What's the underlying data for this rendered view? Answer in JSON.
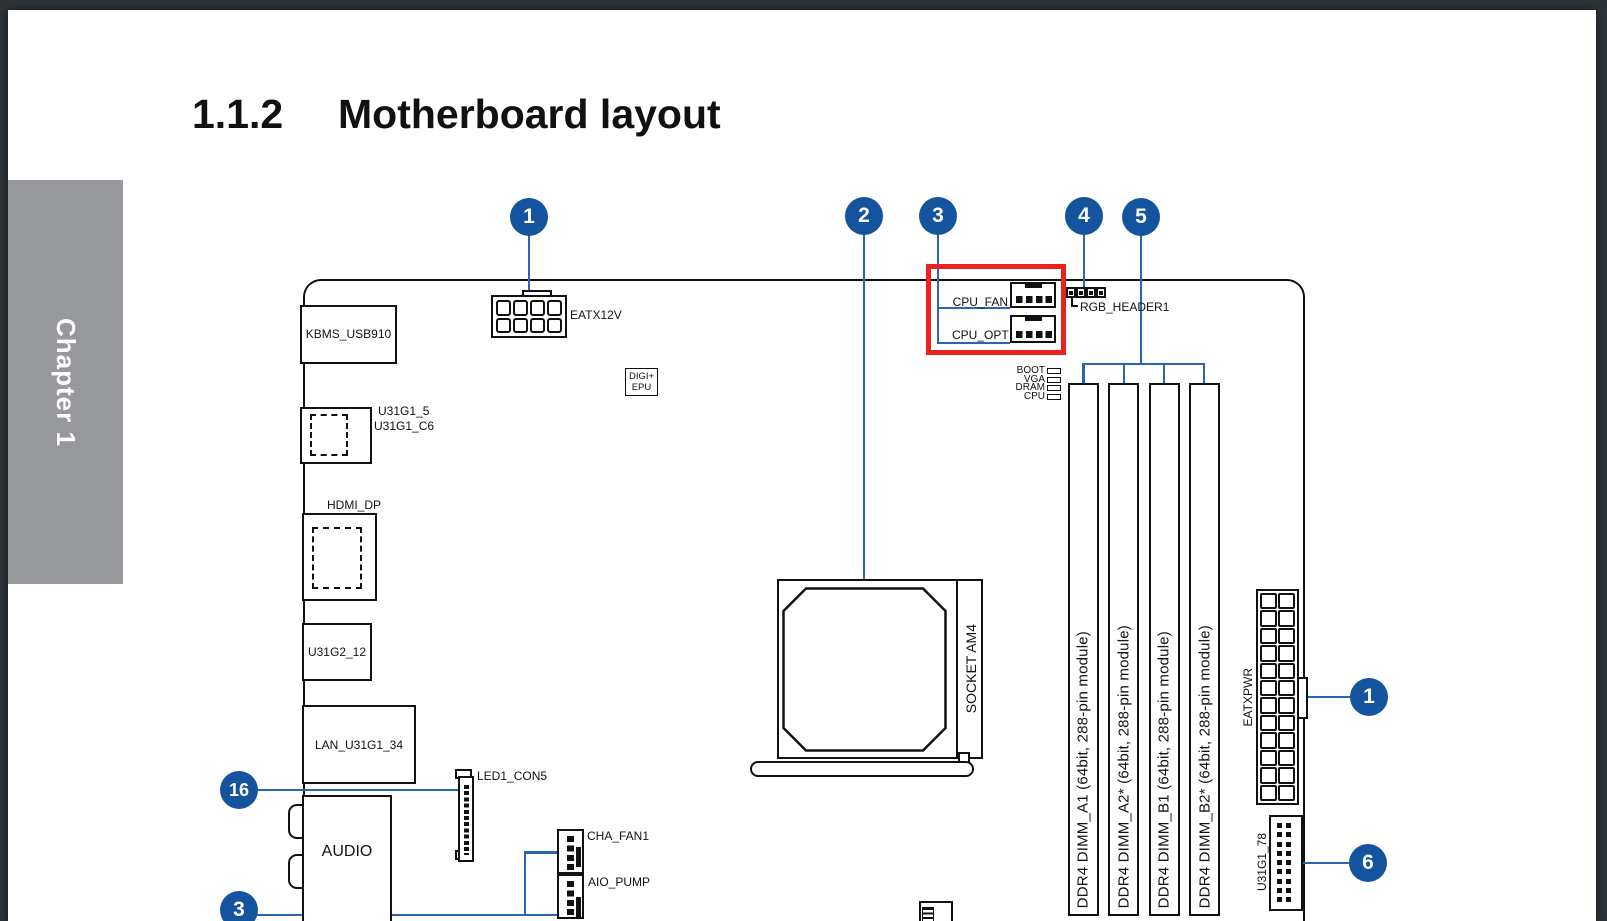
{
  "page": {
    "chapter_tab": "Chapter 1",
    "section_number": "1.1.2",
    "section_title": "Motherboard layout"
  },
  "callouts": {
    "eatx12v": "1",
    "socket": "2",
    "fan_top": "3",
    "rgb": "4",
    "dimm": "5",
    "led_strip": "16",
    "fan_bottom": "3",
    "atx_power": "1",
    "usb_front": "6"
  },
  "connectors": {
    "eatx12v": "EATX12V",
    "kbms": "KBMS_USB910",
    "u31g1_5": "U31G1_5",
    "u31g1_c6": "U31G1_C6",
    "digi_line1": "DIGI+",
    "digi_line2": "EPU",
    "hdmi": "HDMI_DP",
    "u31g2_12": "U31G2_12",
    "lan": "LAN_U31G1_34",
    "audio": "AUDIO",
    "led1_con5": "LED1_CON5",
    "cha_fan1": "CHA_FAN1",
    "aio_pump": "AIO_PUMP",
    "cpu_fan": "CPU_FAN",
    "cpu_opt": "CPU_OPT",
    "rgb_header": "RGB_HEADER1",
    "socket": "SOCKET AM4",
    "eatxpwr": "EATXPWR",
    "u31g1_78": "U31G1_78"
  },
  "leds": {
    "boot": "BOOT",
    "vga": "VGA",
    "dram": "DRAM",
    "cpu": "CPU"
  },
  "dimm_slots": [
    "DDR4 DIMM_A1 (64bit, 288-pin module)",
    "DDR4 DIMM_A2* (64bit, 288-pin module)",
    "DDR4 DIMM_B1 (64bit, 288-pin module)",
    "DDR4 DIMM_B2* (64bit, 288-pin module)"
  ],
  "colors": {
    "callout_blue": "#14539e",
    "leader_blue": "#2a66b0",
    "highlight_red": "#e8231f",
    "tab_gray": "#97989b",
    "frame_dark": "#2e3338",
    "line_black": "#111111"
  }
}
